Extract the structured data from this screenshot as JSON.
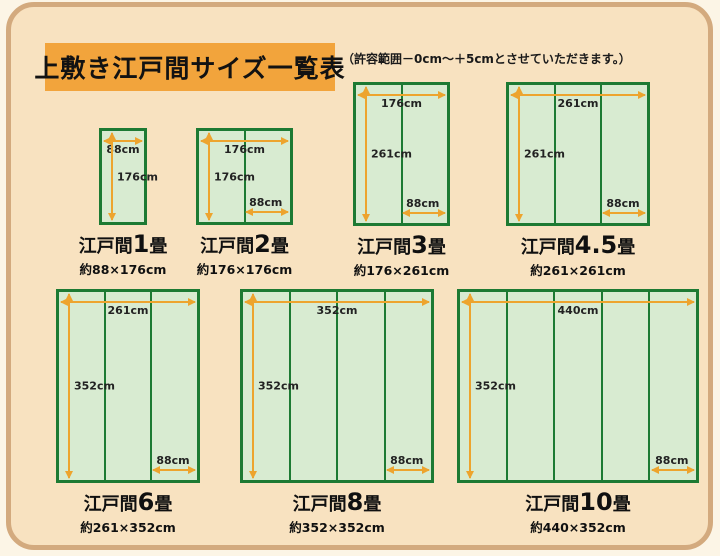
{
  "page": {
    "title": "上敷き江戸間サイズ一覧表",
    "note": "（許容範囲－0cm～＋5cmとさせていただきます。）"
  },
  "colors": {
    "panel_bg": "#f8e2c0",
    "panel_border": "#d3aa7e",
    "title_bg": "#f2a43c",
    "rug_fill": "#d8ebd1",
    "rug_border": "#1d7a33",
    "arrow": "#eda42e"
  },
  "diagrams": [
    {
      "id": "edoma-1jo",
      "title_prefix": "江戸間",
      "title_num": "1",
      "title_suffix": "畳",
      "size_text": "約88×176cm",
      "width_cm": 88,
      "height_cm": 176,
      "panels": 1,
      "top_label": "88cm",
      "side_label": "176cm",
      "panel_label": null
    },
    {
      "id": "edoma-2jo",
      "title_prefix": "江戸間",
      "title_num": "2",
      "title_suffix": "畳",
      "size_text": "約176×176cm",
      "width_cm": 176,
      "height_cm": 176,
      "panels": 2,
      "top_label": "176cm",
      "side_label": "176cm",
      "panel_label": "88cm"
    },
    {
      "id": "edoma-3jo",
      "title_prefix": "江戸間",
      "title_num": "3",
      "title_suffix": "畳",
      "size_text": "約176×261cm",
      "width_cm": 176,
      "height_cm": 261,
      "panels": 2,
      "top_label": "176cm",
      "side_label": "261cm",
      "panel_label": "88cm"
    },
    {
      "id": "edoma-4-5jo",
      "title_prefix": "江戸間",
      "title_num": "4.5",
      "title_suffix": "畳",
      "size_text": "約261×261cm",
      "width_cm": 261,
      "height_cm": 261,
      "panels": 3,
      "top_label": "261cm",
      "side_label": "261cm",
      "panel_label": "88cm"
    },
    {
      "id": "edoma-6jo",
      "title_prefix": "江戸間",
      "title_num": "6",
      "title_suffix": "畳",
      "size_text": "約261×352cm",
      "width_cm": 261,
      "height_cm": 352,
      "panels": 3,
      "top_label": "261cm",
      "side_label": "352cm",
      "panel_label": "88cm"
    },
    {
      "id": "edoma-8jo",
      "title_prefix": "江戸間",
      "title_num": "8",
      "title_suffix": "畳",
      "size_text": "約352×352cm",
      "width_cm": 352,
      "height_cm": 352,
      "panels": 4,
      "top_label": "352cm",
      "side_label": "352cm",
      "panel_label": "88cm"
    },
    {
      "id": "edoma-10jo",
      "title_prefix": "江戸間",
      "title_num": "10",
      "title_suffix": "畳",
      "size_text": "約440×352cm",
      "width_cm": 440,
      "height_cm": 352,
      "panels": 5,
      "top_label": "440cm",
      "side_label": "352cm",
      "panel_label": "88cm"
    }
  ]
}
